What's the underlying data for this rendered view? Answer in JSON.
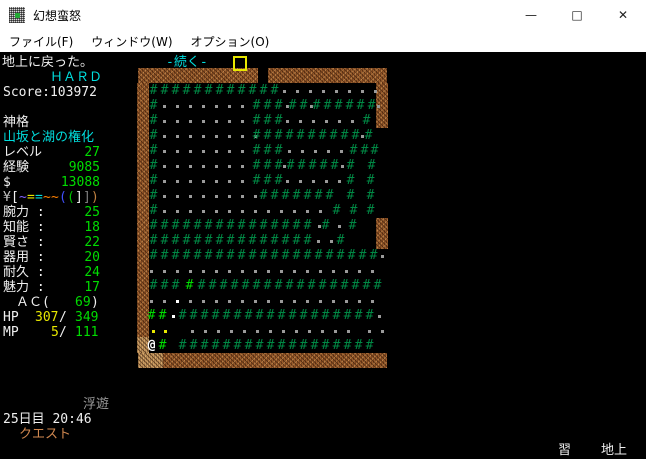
{
  "window": {
    "title": "幻想蛮怒",
    "controls": {
      "minimize": "—",
      "maximize": "□",
      "close": "✕"
    }
  },
  "menu": {
    "items": [
      "ファイル(F)",
      "ウィンドウ(W)",
      "オプション(O)"
    ]
  },
  "message": {
    "text": "地上に戻った。",
    "more_prompt": "-続く-"
  },
  "sidebar": {
    "difficulty": "ＨＡＲＤ",
    "score_line": "Score:103972",
    "race": "神格",
    "class_title": "山坂と湖の権化",
    "progress": [
      {
        "name": "level",
        "label": "レベル",
        "value": "27"
      },
      {
        "name": "exp",
        "label": "経験",
        "value": "9085"
      },
      {
        "name": "gold",
        "label": "$",
        "value": "13088"
      }
    ],
    "equipment_chars": [
      {
        "ch": "¥",
        "c": "#c0c0c0"
      },
      {
        "ch": "[",
        "c": "#f0f0f0"
      },
      {
        "ch": "~",
        "c": "#8060ff"
      },
      {
        "ch": "=",
        "c": "#e8e800"
      },
      {
        "ch": "=",
        "c": "#00dddd"
      },
      {
        "ch": "~",
        "c": "#ff8000"
      },
      {
        "ch": "~",
        "c": "#ff8000"
      },
      {
        "ch": "(",
        "c": "#4050ff"
      },
      {
        "ch": "(",
        "c": "#00c000"
      },
      {
        "ch": "]",
        "c": "#f0f0f0"
      },
      {
        "ch": "]",
        "c": "#808080"
      },
      {
        "ch": ")",
        "c": "#c08040"
      }
    ],
    "abilities": [
      {
        "name": "str",
        "label": "腕力 :",
        "value": "25"
      },
      {
        "name": "int",
        "label": "知能 :",
        "value": "18"
      },
      {
        "name": "wis",
        "label": "賢さ :",
        "value": "22"
      },
      {
        "name": "dex",
        "label": "器用 :",
        "value": "20"
      },
      {
        "name": "con",
        "label": "耐久 :",
        "value": "24"
      },
      {
        "name": "chr",
        "label": "魅力 :",
        "value": "17"
      }
    ],
    "ac": {
      "label": "ＡＣ(",
      "value": "69",
      "close": ")"
    },
    "hp": {
      "label": "HP",
      "current": "307",
      "sep": "/",
      "max": "349"
    },
    "mp": {
      "label": "MP",
      "current": "5",
      "sep": "/",
      "max": "111"
    },
    "status_effect": "浮遊",
    "day_time": "25日目 20:46",
    "quest": "クエスト"
  },
  "footer": {
    "learn": "習",
    "location": "地上"
  },
  "palette": {
    "white": "#f0f0f0",
    "cyan": "#00dddd",
    "green": "#00dd00",
    "yellow": "#e8e800",
    "gray": "#9a9a9a",
    "orange": "#d08850",
    "wall": "#9a5b2b",
    "wall_light": "#c89b62",
    "tree": "#008844",
    "tree_bright": "#00dd00",
    "floor_dot": "#9a9a9a",
    "item_dot": "#ffffff",
    "yellow_dot": "#e8e800",
    "player": "#ffffff"
  },
  "map": {
    "walls": [
      {
        "x": 138,
        "y": 68,
        "w": 120,
        "h": 15,
        "shade": "wall"
      },
      {
        "x": 268,
        "y": 68,
        "w": 119,
        "h": 15,
        "shade": "wall"
      },
      {
        "x": 137,
        "y": 83,
        "w": 12,
        "h": 254,
        "shade": "wall"
      },
      {
        "x": 137,
        "y": 337,
        "w": 12,
        "h": 16,
        "shade": "wall_light"
      },
      {
        "x": 376,
        "y": 83,
        "w": 12,
        "h": 45,
        "shade": "wall"
      },
      {
        "x": 376,
        "y": 218,
        "w": 12,
        "h": 31,
        "shade": "wall"
      },
      {
        "x": 138,
        "y": 353,
        "w": 25,
        "h": 15,
        "shade": "wall_light"
      },
      {
        "x": 163,
        "y": 353,
        "w": 224,
        "h": 15,
        "shade": "wall"
      }
    ],
    "rows": [
      {
        "y": 84,
        "runs": [
          {
            "x": 148,
            "t": "t",
            "n": 12
          },
          {
            "x": 278,
            "t": "d",
            "n": 8
          }
        ]
      },
      {
        "y": 99,
        "runs": [
          {
            "x": 148,
            "t": "t",
            "n": 1
          },
          {
            "x": 158,
            "t": "d",
            "n": 7
          },
          {
            "x": 251,
            "t": "t",
            "n": 3
          },
          {
            "x": 281,
            "t": "d",
            "n": 1
          },
          {
            "x": 287,
            "t": "t",
            "n": 2
          },
          {
            "x": 305,
            "t": "d",
            "n": 1
          },
          {
            "x": 311,
            "t": "t",
            "n": 6
          },
          {
            "x": 372,
            "t": "d",
            "n": 1
          }
        ]
      },
      {
        "y": 114,
        "runs": [
          {
            "x": 148,
            "t": "t",
            "n": 1
          },
          {
            "x": 158,
            "t": "d",
            "n": 7
          },
          {
            "x": 251,
            "t": "t",
            "n": 3
          },
          {
            "x": 281,
            "t": "d",
            "n": 6
          },
          {
            "x": 361,
            "t": "t",
            "n": 1
          }
        ]
      },
      {
        "y": 129,
        "runs": [
          {
            "x": 148,
            "t": "t",
            "n": 1
          },
          {
            "x": 158,
            "t": "d",
            "n": 8
          },
          {
            "x": 251,
            "t": "t",
            "n": 10
          },
          {
            "x": 356,
            "t": "d",
            "n": 1
          },
          {
            "x": 363,
            "t": "t",
            "n": 1
          }
        ]
      },
      {
        "y": 144,
        "runs": [
          {
            "x": 148,
            "t": "t",
            "n": 1
          },
          {
            "x": 158,
            "t": "d",
            "n": 7
          },
          {
            "x": 251,
            "t": "t",
            "n": 3
          },
          {
            "x": 283,
            "t": "d",
            "n": 5
          },
          {
            "x": 348,
            "t": "t",
            "n": 2
          },
          {
            "x": 369,
            "t": "t",
            "n": 1
          }
        ]
      },
      {
        "y": 159,
        "runs": [
          {
            "x": 148,
            "t": "t",
            "n": 1
          },
          {
            "x": 158,
            "t": "d",
            "n": 7
          },
          {
            "x": 251,
            "t": "t",
            "n": 3
          },
          {
            "x": 278,
            "t": "d",
            "n": 1
          },
          {
            "x": 285,
            "t": "t",
            "n": 5
          },
          {
            "x": 336,
            "t": "d",
            "n": 1
          },
          {
            "x": 345,
            "t": "t",
            "n": 1
          },
          {
            "x": 366,
            "t": "t",
            "n": 1
          }
        ]
      },
      {
        "y": 174,
        "runs": [
          {
            "x": 148,
            "t": "t",
            "n": 1
          },
          {
            "x": 158,
            "t": "d",
            "n": 7
          },
          {
            "x": 251,
            "t": "t",
            "n": 3
          },
          {
            "x": 281,
            "t": "d",
            "n": 5
          },
          {
            "x": 345,
            "t": "t",
            "n": 1
          },
          {
            "x": 365,
            "t": "t",
            "n": 1
          }
        ]
      },
      {
        "y": 189,
        "runs": [
          {
            "x": 148,
            "t": "t",
            "n": 1
          },
          {
            "x": 158,
            "t": "d",
            "n": 8
          },
          {
            "x": 258,
            "t": "t",
            "n": 7
          },
          {
            "x": 345,
            "t": "t",
            "n": 1
          },
          {
            "x": 365,
            "t": "t",
            "n": 1
          }
        ]
      },
      {
        "y": 204,
        "runs": [
          {
            "x": 148,
            "t": "t",
            "n": 1
          },
          {
            "x": 158,
            "t": "d",
            "n": 13
          },
          {
            "x": 331,
            "t": "t",
            "n": 1
          },
          {
            "x": 348,
            "t": "t",
            "n": 1
          },
          {
            "x": 365,
            "t": "t",
            "n": 1
          }
        ]
      },
      {
        "y": 219,
        "runs": [
          {
            "x": 148,
            "t": "t",
            "n": 15
          },
          {
            "x": 313,
            "t": "d",
            "n": 1
          },
          {
            "x": 320,
            "t": "t",
            "n": 1
          },
          {
            "x": 333,
            "t": "d",
            "n": 1
          },
          {
            "x": 347,
            "t": "t",
            "n": 1
          }
        ]
      },
      {
        "y": 234,
        "runs": [
          {
            "x": 148,
            "t": "t",
            "n": 15
          },
          {
            "x": 312,
            "t": "d",
            "n": 2
          },
          {
            "x": 335,
            "t": "t",
            "n": 1
          }
        ]
      },
      {
        "y": 249,
        "runs": [
          {
            "x": 148,
            "t": "t",
            "n": 21
          },
          {
            "x": 376,
            "t": "d",
            "n": 1
          }
        ]
      },
      {
        "y": 264,
        "runs": [
          {
            "x": 145,
            "t": "d",
            "n": 18
          }
        ]
      },
      {
        "y": 279,
        "runs": [
          {
            "x": 148,
            "t": "t",
            "n": 3
          },
          {
            "x": 184,
            "t": "T",
            "n": 1
          },
          {
            "x": 196,
            "t": "t",
            "n": 17
          }
        ]
      },
      {
        "y": 294,
        "runs": [
          {
            "x": 145,
            "t": "d",
            "n": 2
          },
          {
            "x": 171,
            "t": "D",
            "n": 1
          },
          {
            "x": 184,
            "t": "d",
            "n": 15
          }
        ]
      },
      {
        "y": 309,
        "runs": [
          {
            "x": 146,
            "t": "T",
            "n": 2
          },
          {
            "x": 167,
            "t": "D",
            "n": 1
          },
          {
            "x": 177,
            "t": "t",
            "n": 18
          },
          {
            "x": 373,
            "t": "d",
            "n": 1
          }
        ]
      },
      {
        "y": 324,
        "runs": [
          {
            "x": 147,
            "t": "y",
            "n": 1
          },
          {
            "x": 159,
            "t": "y",
            "n": 1
          },
          {
            "x": 186,
            "t": "d",
            "n": 13
          },
          {
            "x": 363,
            "t": "d",
            "n": 2
          }
        ]
      },
      {
        "y": 339,
        "runs": [
          {
            "x": 146,
            "t": "@",
            "n": 1
          },
          {
            "x": 157,
            "t": "T",
            "n": 1
          },
          {
            "x": 177,
            "t": "t",
            "n": 18
          }
        ]
      }
    ]
  }
}
